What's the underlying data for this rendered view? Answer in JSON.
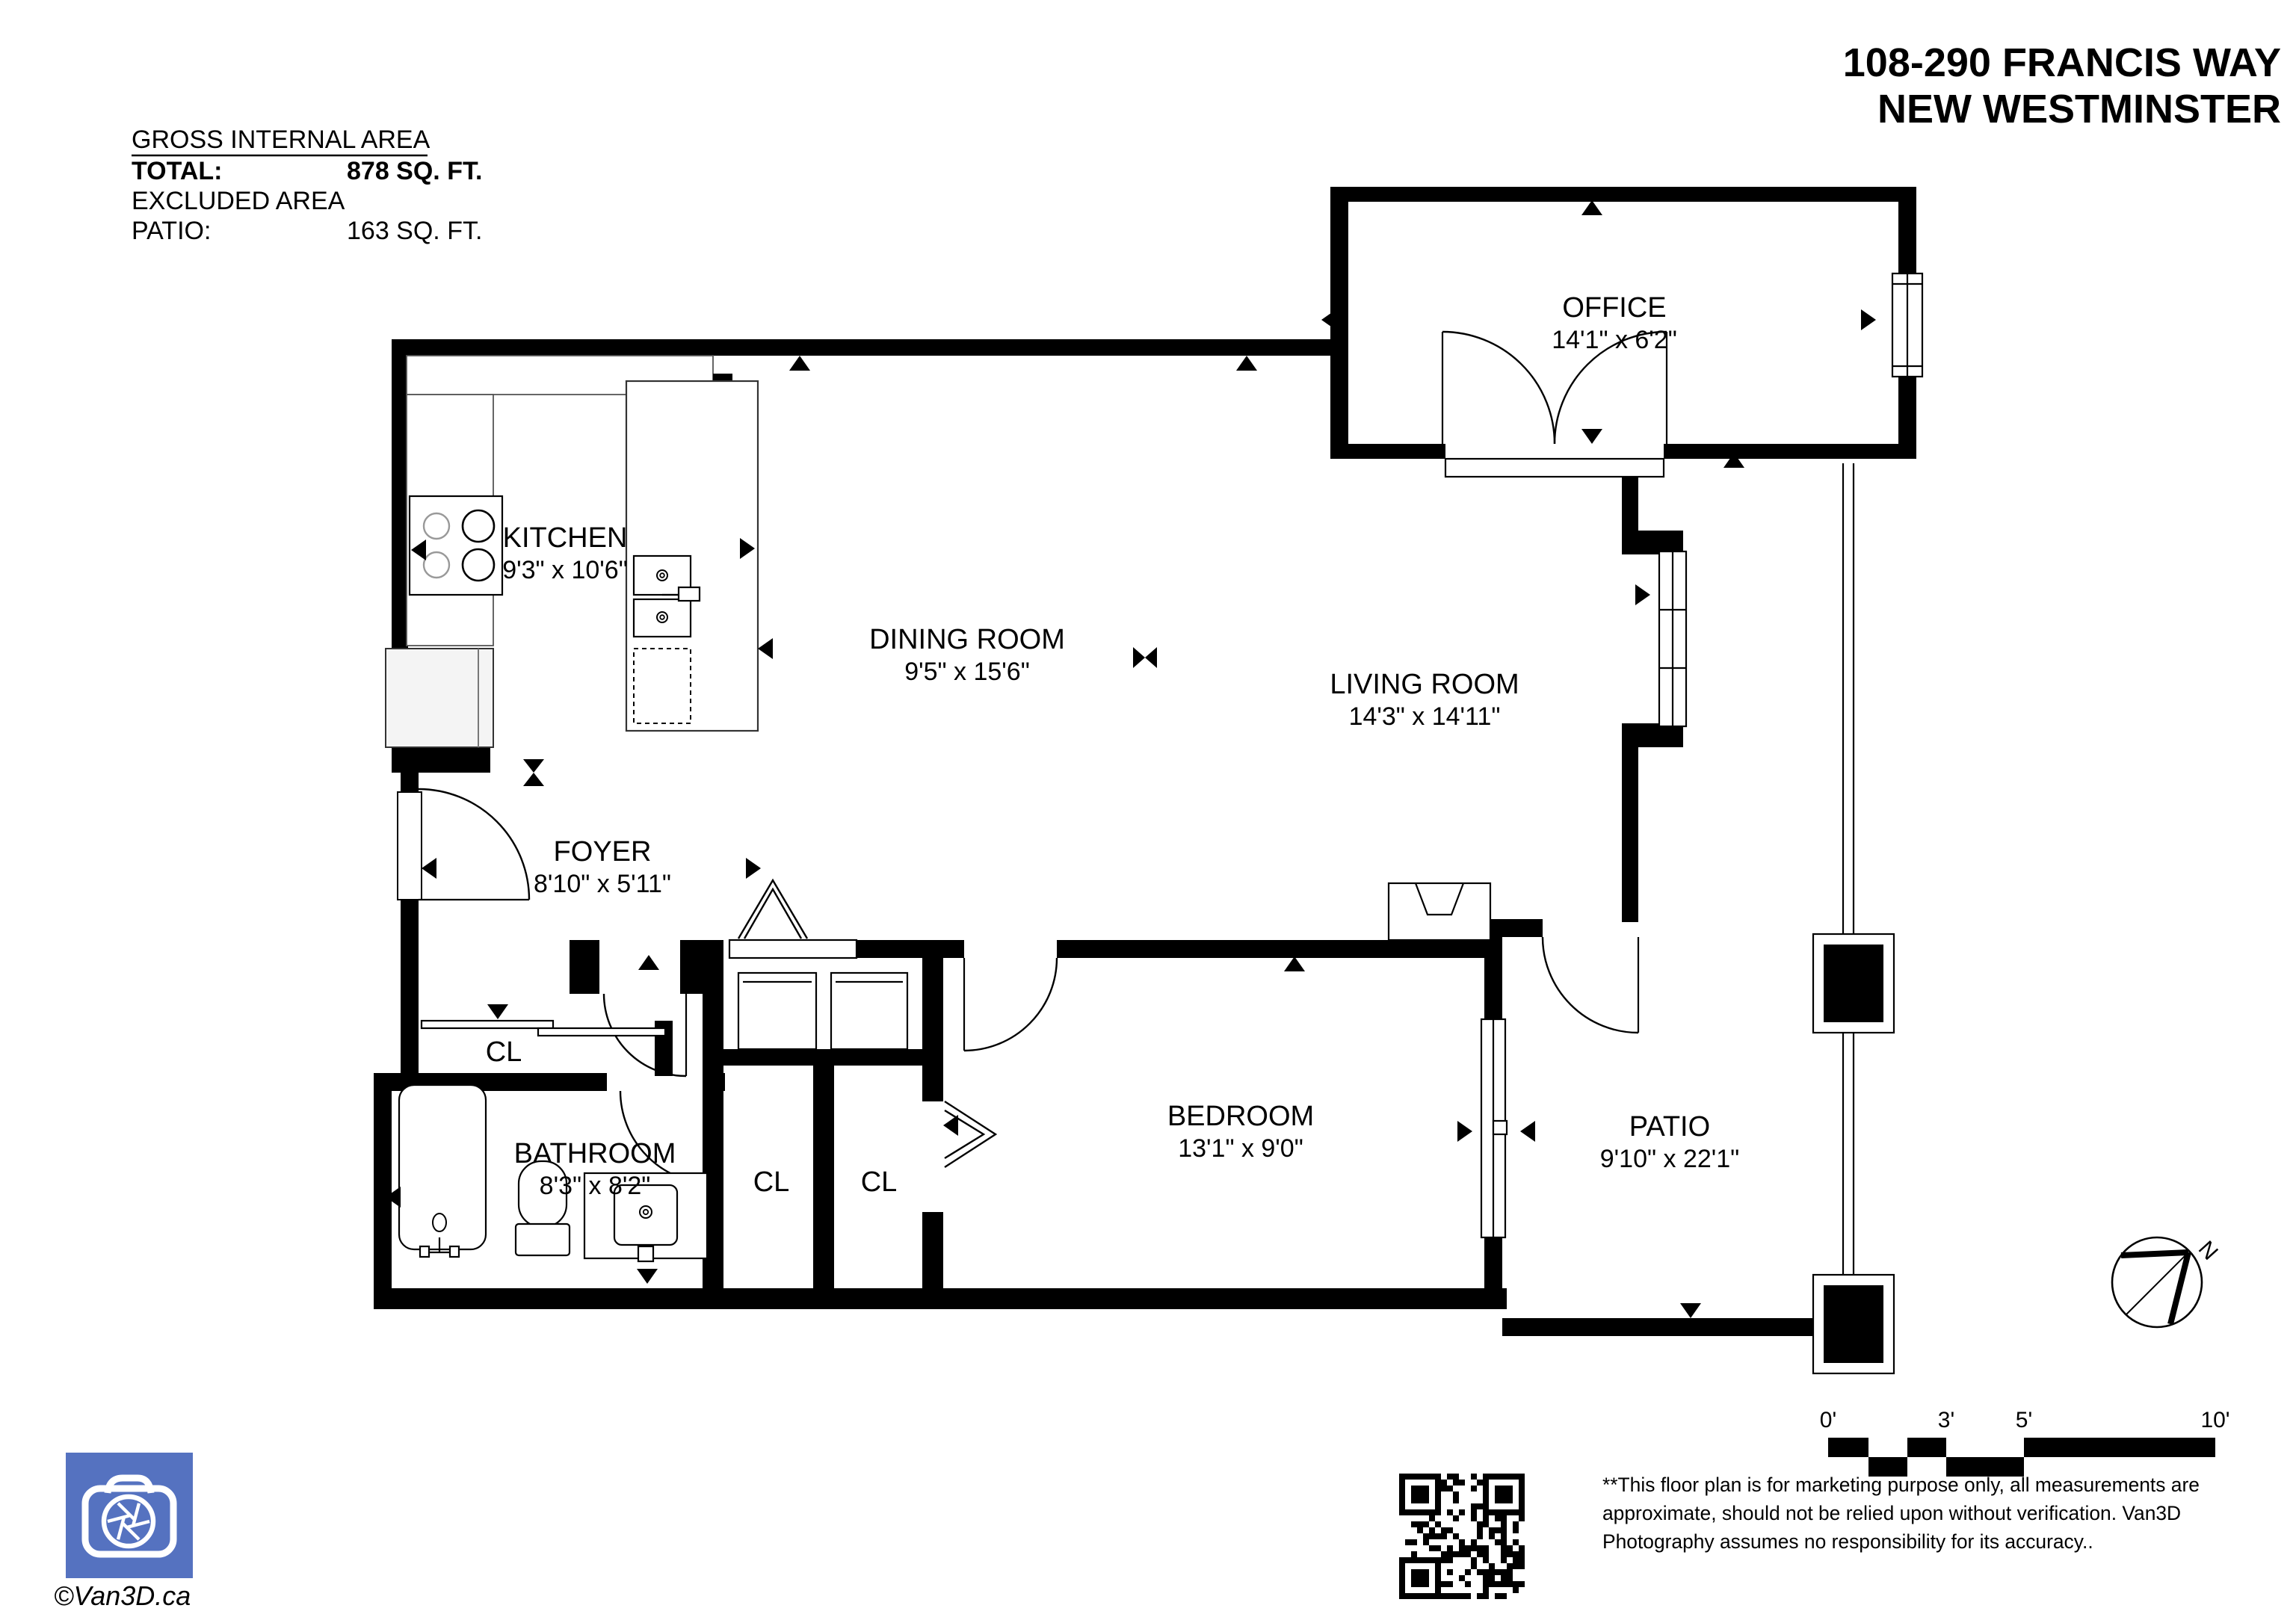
{
  "header": {
    "title_line1": "108-290 FRANCIS WAY",
    "title_line2": "NEW WESTMINSTER"
  },
  "area_summary": {
    "heading": "GROSS INTERNAL AREA",
    "total_label": "TOTAL:",
    "total_value": "878 SQ. FT.",
    "excluded_label": "EXCLUDED AREA",
    "patio_label": "PATIO:",
    "patio_value": "163 SQ. FT."
  },
  "rooms": {
    "office": {
      "name": "OFFICE",
      "dims": "14'1\" x 6'2\""
    },
    "kitchen": {
      "name": "KITCHEN",
      "dims": "9'3\" x 10'6\""
    },
    "dining": {
      "name": "DINING ROOM",
      "dims": "9'5\" x 15'6\""
    },
    "living": {
      "name": "LIVING ROOM",
      "dims": "14'3\" x 14'11\""
    },
    "foyer": {
      "name": "FOYER",
      "dims": "8'10\" x 5'11\""
    },
    "bathroom": {
      "name": "BATHROOM",
      "dims": "8'3\" x 8'2\""
    },
    "bedroom": {
      "name": "BEDROOM",
      "dims": "13'1\" x 9'0\""
    },
    "patio": {
      "name": "PATIO",
      "dims": "9'10\" x 22'1\""
    },
    "closet_foyer": {
      "name": "CL"
    },
    "closet_1": {
      "name": "CL"
    },
    "closet_2": {
      "name": "CL"
    }
  },
  "scale_bar": {
    "labels": [
      "0'",
      "3'",
      "5'",
      "10'"
    ]
  },
  "compass": {
    "north_label": "N"
  },
  "disclaimer": {
    "line1": "**This floor plan is for marketing purpose only, all measurements are",
    "line2": "approximate, should not be relied upon without verification. Van3D",
    "line3": "Photography assumes no responsibility for its accuracy.."
  },
  "footer": {
    "credit": "©Van3D.ca"
  },
  "colors": {
    "wall": "#000000",
    "logo_blue": "#5572c0",
    "credit_gray": "#8e8e8e"
  }
}
